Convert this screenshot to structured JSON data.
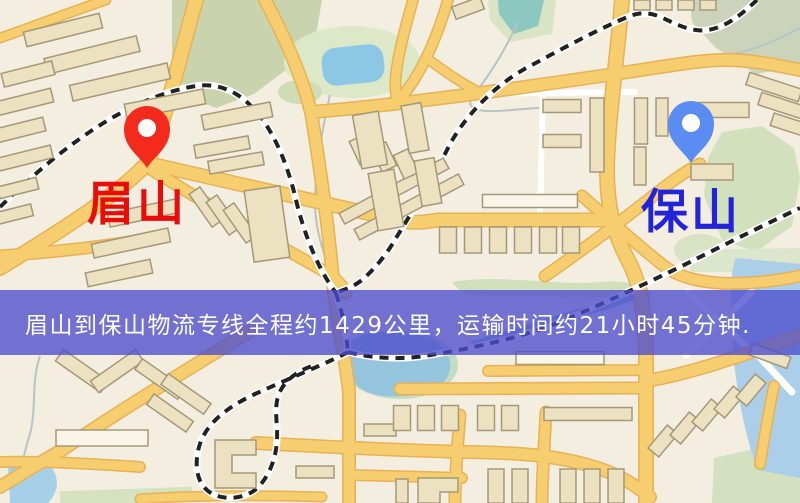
{
  "banner": {
    "text": "眉山到保山物流专线全程约1429公里，运输时间约21小时45分钟.",
    "bg_color": "#4d4dcd",
    "text_color": "#ffffff"
  },
  "route": {
    "from": "眉山",
    "to": "保山",
    "distance": "1429公里",
    "duration": "21小时45分钟"
  },
  "markers": {
    "origin": {
      "label": "眉山",
      "pin_color": "#f32a1c",
      "label_color": "#ea0b0b"
    },
    "destination": {
      "label": "保山",
      "pin_color": "#5a8cf2",
      "label_color": "#2423dc"
    }
  },
  "map": {
    "background": "#f3eee0",
    "road_fill": "#f7ce6f",
    "road_casing": "#e7b155",
    "water_color": "#a8cde6",
    "pond_color": "#8cc8e6",
    "park_color": "#d2e0bd",
    "railway_color": "#222222",
    "building_fill": "#ece1c0",
    "building_stroke": "#a49878"
  }
}
